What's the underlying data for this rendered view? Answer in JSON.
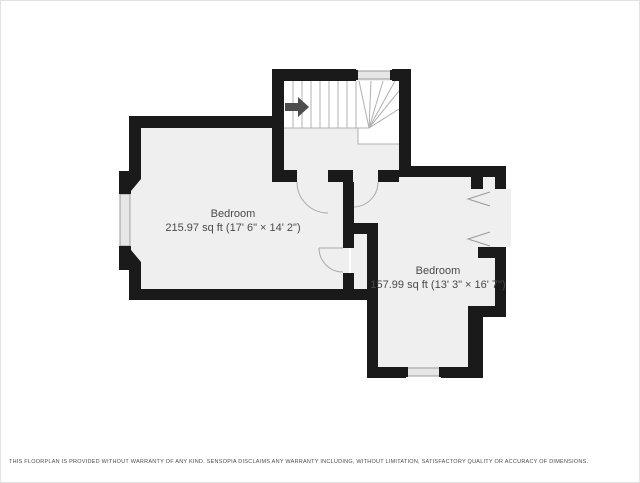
{
  "page": {
    "background": "#ffffff",
    "border_color": "#e2e2e2"
  },
  "floorplan": {
    "colors": {
      "wall": "#1a1a1a",
      "floor": "#efefef",
      "stairs_fill": "#ffffff",
      "window_fill": "#e6e6e6",
      "window_stroke": "#9a9a9a",
      "door_arc": "#aaaaaa",
      "stair_lines": "#b0b0b0",
      "opening_chevron": "#9a9a9a",
      "arrow": "#4d4d4d",
      "label_text": "#4a4a4a"
    },
    "rooms": [
      {
        "name": "Bedroom",
        "details": "215.97 sq ft (17' 6\" × 14' 2\")"
      },
      {
        "name": "Bedroom",
        "details": "157.99 sq ft (13' 3\" × 16' 7\")"
      }
    ],
    "features": {
      "stairs_arrow": "up-direction-arrow",
      "windows": 3,
      "door_swings": 3,
      "wall_openings": 2
    }
  },
  "footer": {
    "disclaimer": "THIS FLOORPLAN IS PROVIDED WITHOUT WARRANTY OF ANY KIND. SENSOPIA DISCLAIMS ANY WARRANTY INCLUDING, WITHOUT LIMITATION, SATISFACTORY QUALITY OR ACCURACY OF DIMENSIONS."
  }
}
